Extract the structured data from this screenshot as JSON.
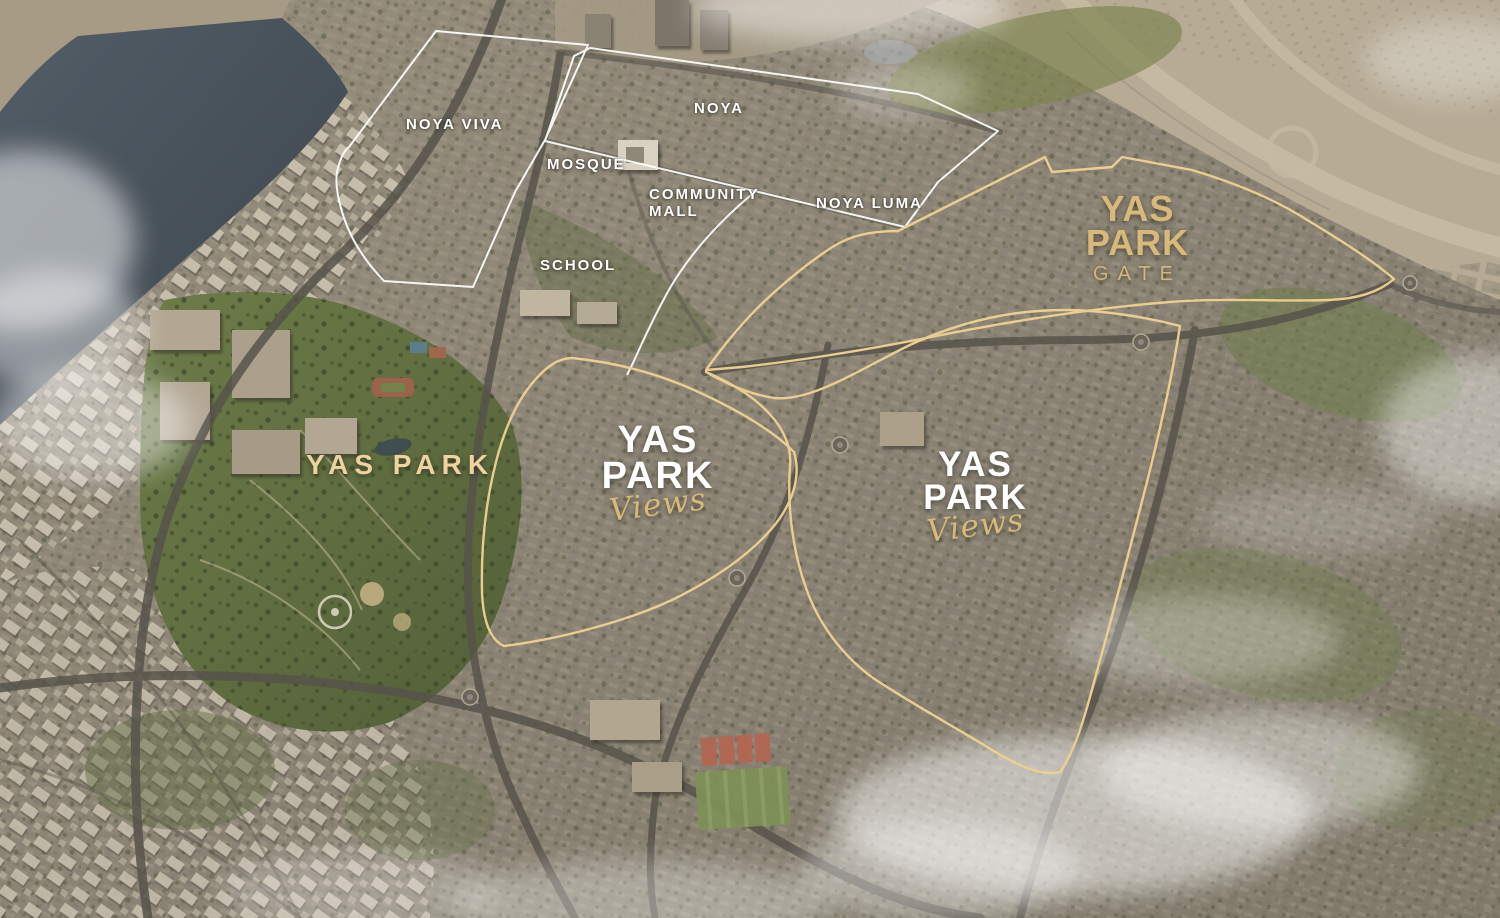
{
  "map": {
    "type": "masterplan-aerial",
    "title": "Yas Park communities masterplan aerial view",
    "labels": {
      "noya_viva": "NOYA VIVA",
      "noya": "NOYA",
      "mosque": "MOSQUE",
      "community_mall": "COMMUNITY MALL",
      "noya_luma": "NOYA LUMA",
      "school": "SCHOOL",
      "yas_park": "YAS PARK"
    },
    "logos": {
      "gate": {
        "line1": "YAS",
        "line2": "PARK",
        "line3": "GATE"
      },
      "views_left": {
        "line1": "YAS",
        "line2": "PARK",
        "script": "Views"
      },
      "views_right": {
        "line1": "YAS",
        "line2": "PARK",
        "script": "Views"
      }
    },
    "districts": [
      {
        "name": "NOYA VIVA",
        "outline": "white"
      },
      {
        "name": "NOYA",
        "outline": "white"
      },
      {
        "name": "NOYA LUMA",
        "outline": "white"
      },
      {
        "name": "YAS PARK GATE",
        "outline": "gold"
      },
      {
        "name": "YAS PARK VIEWS (west)",
        "outline": "gold"
      },
      {
        "name": "YAS PARK VIEWS (east)",
        "outline": "gold"
      }
    ],
    "colors": {
      "gold_boundary": "#eed092",
      "gold_text": "#d8b97a",
      "gold_label": "#eed2a0",
      "white_label": "#ffffff"
    }
  }
}
